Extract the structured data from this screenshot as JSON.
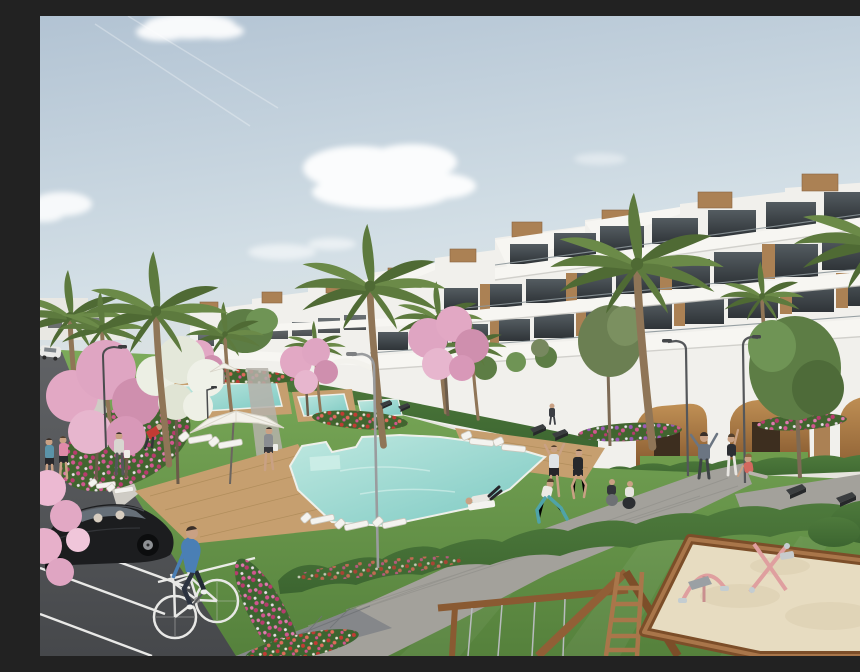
{
  "image": {
    "alt": "Architectural render of a modern white terraced apartment complex with rooftop wood accents, landscaped gardens, palm and blossom trees, turquoise swimming pools with sun loungers and parasols, people exercising on lawns, a parking area with a black hatchback car, a cyclist, and a children's playground with a wooden sandbox and swing frame under a pale blue sky.",
    "type": "architectural-visualization"
  },
  "palette": {
    "sky_top": "#b2c3d3",
    "sky_mid": "#d3dfe6",
    "sky_horizon": "#e9e6dc",
    "cloud": "#ffffff",
    "building_white": "#f1f0ec",
    "building_shade": "#dddcd7",
    "band_white": "#f7f6f2",
    "wood_accent": "#ab8154",
    "wood_dark": "#8a6440",
    "window_glass_top": "#545c61",
    "window_glass_bottom": "#2f3438",
    "railing": "#8d979b",
    "grass_light": "#7cab5a",
    "grass_dark": "#55813c",
    "hedge_green": "#3c6530",
    "hedge_light": "#4e7a3c",
    "pool_light": "#bfe8e0",
    "pool_deep": "#7cc9c2",
    "pool_edge": "#eef0ea",
    "deck_wood": "#c69f6f",
    "deck_line": "#ad8a58",
    "path_concrete": "#a3a19b",
    "path_joint": "#91908b",
    "crossing_brick": "#85878a",
    "sidewalk": "#cfccc5",
    "asphalt_top": "#606265",
    "asphalt_bottom": "#46484b",
    "road_marking": "#f2f2f0",
    "sand": "#e7dcc1",
    "timber_frame": "#8a5a32",
    "timber_light": "#a9764a",
    "blossom_pink": "#e2a8c4",
    "blossom_deep": "#cf8fae",
    "blossom_white": "#ecefe4",
    "palm_green": "#5d7a3e",
    "palm_light": "#6b8a48",
    "palm_dark": "#4f6a34",
    "tree_green": "#5d7d45",
    "trunk_brown": "#8f7557",
    "car_black": "#1c1d1f",
    "car_glass": "#6c7680",
    "bike_white": "#e8e8e6",
    "cyclist_blue": "#4a7fb5",
    "skin": "#c9a184",
    "toy_pink": "#df9f9f",
    "lamp_metal": "#9a9c9e",
    "lamp_dark": "#4a4c4e",
    "flower_magenta": "#d1568f",
    "flower_red": "#c23b34",
    "flower_purple": "#9b59b6"
  },
  "scene": {
    "sky": {
      "clouds": 5,
      "contrails": 2
    },
    "buildings": {
      "style": "modern stepped terrace apartments",
      "features": [
        "rooftop wood-slat boxes",
        "glass balustrades",
        "tinted glazing",
        "ground-floor arcade with ochre arches"
      ]
    },
    "amenities": [
      "swimming pools",
      "sun loungers",
      "white parasols",
      "street lamps",
      "benches",
      "sandbox playground",
      "swing frame"
    ],
    "vegetation": [
      "palm trees",
      "pink blossom trees",
      "white blossom tree",
      "flower beds",
      "hedges",
      "lawns"
    ],
    "people": {
      "pedestrians": 5,
      "cyclist": 1,
      "exercising": 6,
      "relaxing": 3,
      "gardener": 1
    },
    "vehicles": {
      "foreground_car": "black hatchback",
      "bicycle": "white city bike",
      "distant_car": "white"
    },
    "pools": 3
  }
}
